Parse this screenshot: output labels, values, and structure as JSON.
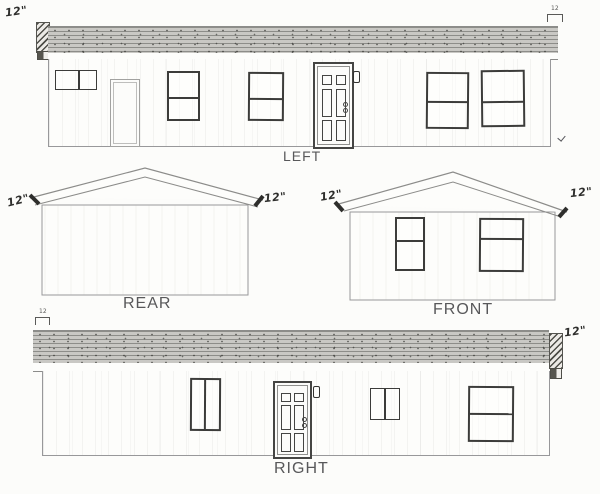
{
  "title": "House elevation drawings",
  "elevations": {
    "left": {
      "label": "LEFT"
    },
    "rear": {
      "label": "REAR"
    },
    "front": {
      "label": "FRONT"
    },
    "right": {
      "label": "RIGHT"
    }
  },
  "annotations": {
    "left_overhang": "12\"",
    "left_dim": "12",
    "rear_left_overhang": "12\"",
    "rear_right_overhang": "12\"",
    "front_left_overhang": "12\"",
    "front_right_overhang": "12\"",
    "right_dim": "12",
    "right_overhang": "12\""
  },
  "colors": {
    "line": "#8c8c8a",
    "dark_line": "#30302e",
    "roof_fill": "#c9c8c4",
    "label_text": "#58585a",
    "background": "#fcfcfa"
  }
}
